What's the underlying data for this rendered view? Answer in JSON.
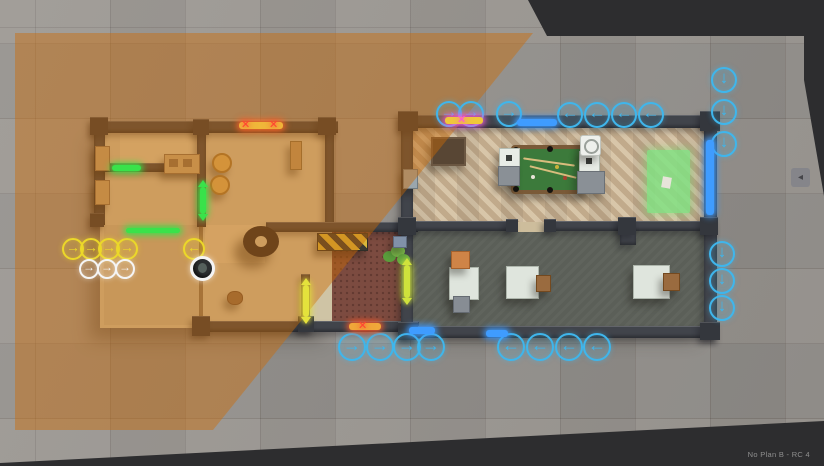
{
  "meta": {
    "version_label": "No Plan B - RC 4"
  },
  "colors": {
    "accent_blue": "#3fb6ec",
    "team_yellow": "#ecd829",
    "team_white": "#f5f5f5",
    "door_green": "#39e24a",
    "door_yellow": "#e4e23c",
    "blocked_red": "#ff4432",
    "blocked_magenta": "#ff55d6",
    "door_blue": "#3f9cff",
    "overlay_orange": "#ce6c05",
    "letterbox": "#2d2d2f"
  },
  "waypoint_groups": [
    {
      "name": "yellow-right",
      "color": "#ecd829",
      "dir": "right",
      "r": 9,
      "points": [
        [
          71,
          247
        ],
        [
          89,
          247
        ],
        [
          107,
          247
        ],
        [
          125,
          247
        ]
      ]
    },
    {
      "name": "yellow-left",
      "color": "#ecd829",
      "dir": "left",
      "r": 9,
      "points": [
        [
          192,
          247
        ]
      ]
    },
    {
      "name": "white-right",
      "color": "#f5f5f5",
      "dir": "right",
      "r": 8,
      "points": [
        [
          87,
          267
        ],
        [
          105,
          267
        ],
        [
          123,
          267
        ]
      ]
    },
    {
      "name": "blue-top-right",
      "color": "#3fb6ec",
      "dir": "right",
      "r": 11,
      "points": [
        [
          447,
          112
        ],
        [
          469,
          112
        ],
        [
          507,
          112
        ]
      ]
    },
    {
      "name": "blue-top-left",
      "color": "#3fb6ec",
      "dir": "left",
      "r": 11,
      "points": [
        [
          568,
          113
        ],
        [
          595,
          113
        ],
        [
          622,
          113
        ],
        [
          649,
          113
        ]
      ]
    },
    {
      "name": "blue-bottom-right",
      "color": "#3fb6ec",
      "dir": "right",
      "r": 12,
      "points": [
        [
          350,
          345
        ],
        [
          378,
          345
        ],
        [
          405,
          345
        ],
        [
          429,
          345
        ]
      ]
    },
    {
      "name": "blue-bottom-left",
      "color": "#3fb6ec",
      "dir": "left",
      "r": 12,
      "points": [
        [
          509,
          345
        ],
        [
          538,
          345
        ],
        [
          567,
          345
        ],
        [
          595,
          345
        ]
      ]
    },
    {
      "name": "blue-right-down-upper",
      "color": "#3fb6ec",
      "dir": "down",
      "r": 11,
      "points": [
        [
          722,
          78
        ],
        [
          722,
          110
        ],
        [
          722,
          142
        ]
      ]
    },
    {
      "name": "blue-right-down-lower",
      "color": "#3fb6ec",
      "dir": "down",
      "r": 11,
      "points": [
        [
          720,
          252
        ],
        [
          720,
          279
        ],
        [
          720,
          306
        ]
      ]
    }
  ],
  "door_markers": [
    {
      "name": "door-green-horizontal",
      "color": "#39e24a",
      "x": 112,
      "y": 165,
      "w": 29,
      "h": 6,
      "tips": false
    },
    {
      "name": "door-green-vertical",
      "color": "#39e24a",
      "x": 200,
      "y": 187,
      "w": 6,
      "h": 27,
      "tips": true
    },
    {
      "name": "window-green",
      "color": "#39e24a",
      "x": 126,
      "y": 228,
      "w": 54,
      "h": 5,
      "tips": false
    },
    {
      "name": "door-yellow-vertical-1",
      "color": "#e4e23c",
      "x": 303,
      "y": 285,
      "w": 6,
      "h": 32,
      "tips": true
    },
    {
      "name": "door-yellow-vertical-2",
      "color": "#cfe23c",
      "x": 404,
      "y": 265,
      "w": 6,
      "h": 33,
      "tips": true
    },
    {
      "name": "door-blocked-left",
      "color": "#f0b83a",
      "glow": "#ff6a2a",
      "x": 239,
      "y": 122,
      "w": 44,
      "h": 7,
      "xs": [
        [
          247,
          125
        ],
        [
          275,
          125
        ]
      ],
      "x_color": "#ff4432"
    },
    {
      "name": "door-blocked-top",
      "color": "#f0c83a",
      "glow": "#ff55d6",
      "x": 445,
      "y": 117,
      "w": 38,
      "h": 7,
      "xs": [
        [
          463,
          120
        ]
      ],
      "x_color": "#ff55d6"
    },
    {
      "name": "door-blocked-bottom",
      "color": "#f0a83a",
      "glow": "#ff5a2a",
      "x": 349,
      "y": 323,
      "w": 32,
      "h": 7,
      "xs": [
        [
          364,
          326
        ]
      ],
      "x_color": "#ff4432"
    },
    {
      "name": "door-blue-top",
      "color": "#3f9cff",
      "x": 517,
      "y": 119,
      "w": 40,
      "h": 7
    },
    {
      "name": "door-blue-right",
      "color": "#3f9cff",
      "x": 706,
      "y": 140,
      "w": 8,
      "h": 75
    },
    {
      "name": "door-blue-bottom-1",
      "color": "#3f9cff",
      "x": 409,
      "y": 327,
      "w": 26,
      "h": 7
    },
    {
      "name": "door-blue-bottom-2",
      "color": "#3f9cff",
      "x": 486,
      "y": 330,
      "w": 22,
      "h": 7
    }
  ],
  "agents": [
    {
      "x": 201,
      "y": 267
    }
  ],
  "side_handle": {
    "glyph": "◂"
  }
}
